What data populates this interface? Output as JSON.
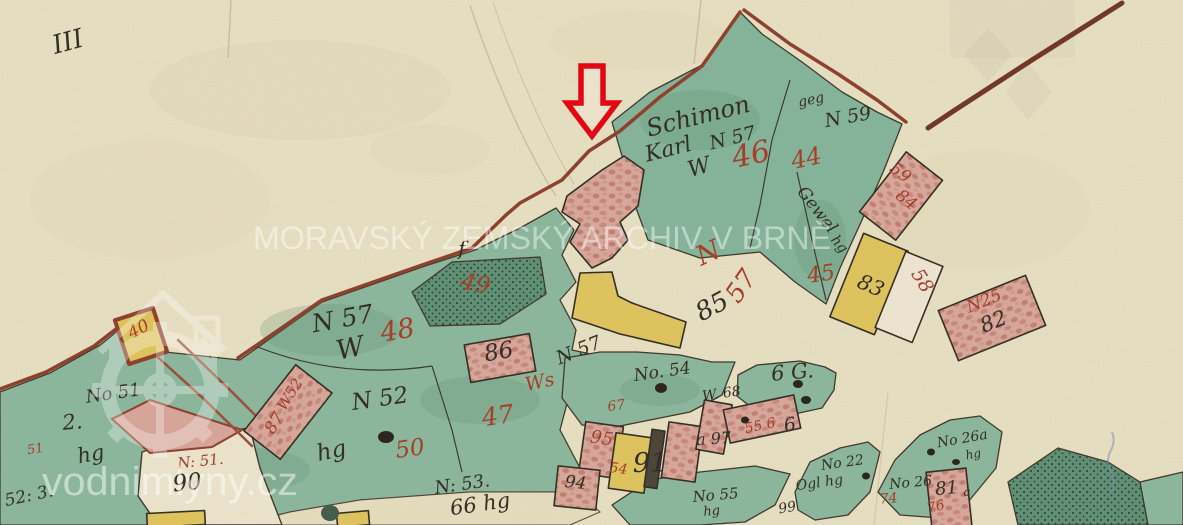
{
  "watermarks": {
    "archive": "MORAVSKÝ ZEMSKÝ ARCHIV V BRNĚ",
    "site": "vodnimlyny.cz",
    "logo_icon": "watermill-house-gear"
  },
  "annotation": {
    "arrow_icon": "red-down-arrow",
    "arrow_color": "#e30613"
  },
  "palette": {
    "paper": "#e8e0c3",
    "parcel_green": "#8ab79c",
    "parcel_green_dark": "#5d8e74",
    "building_pink": "#d7a79b",
    "building_yellow": "#dfc45c",
    "boundary_red": "#8c3d2b",
    "ink_black": "#2f2a22",
    "ink_red": "#a63a26"
  },
  "map": {
    "labels": [
      {
        "text": "III",
        "ink": "black"
      },
      {
        "text": "Schimon",
        "ink": "black"
      },
      {
        "text": "Karl",
        "ink": "black"
      },
      {
        "text": "N 57",
        "ink": "black"
      },
      {
        "text": "W",
        "ink": "black"
      },
      {
        "text": "46",
        "ink": "red"
      },
      {
        "text": "geg",
        "ink": "black"
      },
      {
        "text": "N 59",
        "ink": "black"
      },
      {
        "text": "44",
        "ink": "red"
      },
      {
        "text": "Gewel",
        "ink": "black"
      },
      {
        "text": "hg",
        "ink": "black"
      },
      {
        "text": "45",
        "ink": "red"
      },
      {
        "text": "59",
        "ink": "red"
      },
      {
        "text": "84",
        "ink": "red"
      },
      {
        "text": "83",
        "ink": "black"
      },
      {
        "text": "58",
        "ink": "red"
      },
      {
        "text": "N25",
        "ink": "red"
      },
      {
        "text": "82",
        "ink": "black"
      },
      {
        "text": "N",
        "ink": "red"
      },
      {
        "text": "57",
        "ink": "red"
      },
      {
        "text": "85",
        "ink": "black"
      },
      {
        "text": "f",
        "ink": "black"
      },
      {
        "text": "49",
        "ink": "red"
      },
      {
        "text": "N 57",
        "ink": "black"
      },
      {
        "text": "W",
        "ink": "black"
      },
      {
        "text": "48",
        "ink": "red"
      },
      {
        "text": "86",
        "ink": "black"
      },
      {
        "text": "Ws",
        "ink": "red"
      },
      {
        "text": "N 52",
        "ink": "black"
      },
      {
        "text": "W52",
        "ink": "red"
      },
      {
        "text": "87",
        "ink": "red"
      },
      {
        "text": "47",
        "ink": "red"
      },
      {
        "text": "hg",
        "ink": "black"
      },
      {
        "text": "50",
        "ink": "red"
      },
      {
        "text": "N: 53.",
        "ink": "black"
      },
      {
        "text": "66 hg",
        "ink": "black"
      },
      {
        "text": "No. 54",
        "ink": "black"
      },
      {
        "text": "67",
        "ink": "red"
      },
      {
        "text": "W. 68",
        "ink": "black"
      },
      {
        "text": "6 G.",
        "ink": "black"
      },
      {
        "text": "95",
        "ink": "red"
      },
      {
        "text": "54",
        "ink": "red"
      },
      {
        "text": "91",
        "ink": "black"
      },
      {
        "text": "a 97",
        "ink": "black"
      },
      {
        "text": "55 6",
        "ink": "red"
      },
      {
        "text": "6",
        "ink": "black"
      },
      {
        "text": "94",
        "ink": "black"
      },
      {
        "text": "No 22",
        "ink": "black"
      },
      {
        "text": "Ogl hg",
        "ink": "black"
      },
      {
        "text": "99",
        "ink": "black"
      },
      {
        "text": "No 55",
        "ink": "black"
      },
      {
        "text": "hg",
        "ink": "black"
      },
      {
        "text": "No 26a",
        "ink": "black"
      },
      {
        "text": "hg",
        "ink": "black"
      },
      {
        "text": "No 26",
        "ink": "black"
      },
      {
        "text": "81",
        "ink": "black"
      },
      {
        "text": "a",
        "ink": "black"
      },
      {
        "text": "74",
        "ink": "red"
      },
      {
        "text": "76",
        "ink": "red"
      },
      {
        "text": "N: 51.",
        "ink": "red"
      },
      {
        "text": "90",
        "ink": "black"
      },
      {
        "text": "No 51",
        "ink": "black"
      },
      {
        "text": "2.",
        "ink": "black"
      },
      {
        "text": "51",
        "ink": "red"
      },
      {
        "text": "hg",
        "ink": "black"
      },
      {
        "text": "52: 3.",
        "ink": "black"
      },
      {
        "text": "40",
        "ink": "red"
      },
      {
        "text": "N 57",
        "ink": "black"
      }
    ]
  }
}
